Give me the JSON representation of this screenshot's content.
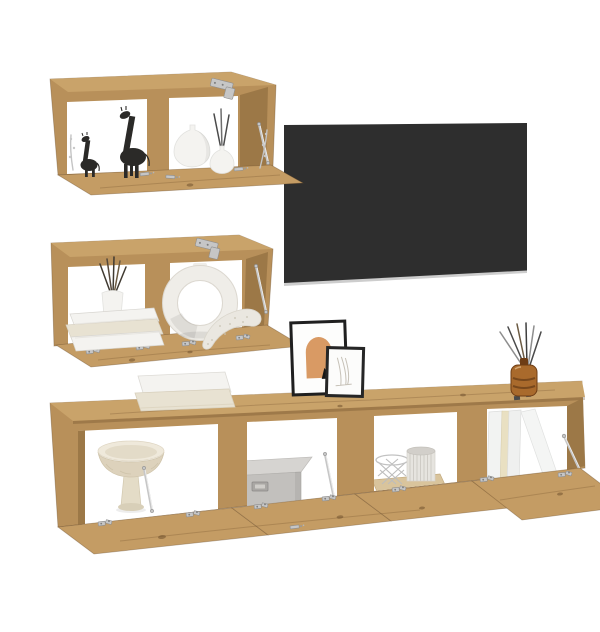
{
  "meta": {
    "title": "TV wall unit set in artisan oak - product image",
    "description": "Five-piece wall-mounted TV cabinet set in artisan oak with open fold-down doors, styled with giraffe figurines, white vases, books, a ring sculpture, a grey storage box, baskets, binders, two art frames, a reed diffuser and a wall-mounted flat screen TV on a white background."
  },
  "colors": {
    "background": "#ffffff",
    "wood-mid": "#b8905a",
    "wood-top": "#c9a36a",
    "wood-flap": "#c49c64",
    "wood-dark": "#9c7847",
    "wood-board": "#d9c49c",
    "tv-screen": "#2e2e2e",
    "tv-edge": "#cdcdcd",
    "metal": "#c6c6c6",
    "metal-dark": "#8e8e8e",
    "decor-white": "#f4f3f0",
    "decor-cream": "#e8e2d2",
    "gray-box-front": "#c2c0bd",
    "gray-box-top": "#d6d4d1",
    "figure-black": "#2b2a28",
    "art-orange": "#d99a64",
    "frame-black": "#1f1f1f",
    "amber": "#a96a2c",
    "amber-dark": "#6e3d15"
  },
  "scene": {
    "tv": {
      "label": "Wall-mounted flat screen TV"
    },
    "wall_cabinet_top": {
      "label": "Wall-mounted cabinet, artisan oak, two open compartments with fold-down door",
      "decor": {
        "twig_left": "Silver twig ornament",
        "giraffe_small": "Black giraffe figurine (small)",
        "giraffe_large": "Black giraffe figurine (large)",
        "vase_large": "Large white teardrop vase",
        "vase_small": "Small white vase with reed sticks",
        "twig_right": "Silver twig ornament"
      }
    },
    "wall_cabinet_middle": {
      "label": "Wall-mounted cabinet, artisan oak, two open compartments with fold-down door",
      "decor": {
        "reed_vase": "White vase with dark reed sticks",
        "books": "Stack of white books",
        "ring": "White ring-shaped sculpture",
        "horn": "Speckled horn ornament"
      }
    },
    "tv_stand": {
      "label": "Low TV stand, artisan oak, four open compartments with fold-down doors",
      "decor": {
        "books_top": "Stack of white and cream books",
        "pedestal_bowl": "Fluted pedestal bowl",
        "storage_box": "Grey fabric storage box with metal label plate",
        "wire_basket": "Silver wire basket",
        "ribbed_pot": "Ribbed white pot",
        "wood_board": "Light wood board",
        "binders": "White books and binders",
        "diffuser": "Amber reed diffuser bottle"
      }
    },
    "art_frames": {
      "label": "Two leaning picture frames",
      "large": "Framed orange abstract print",
      "small": "Framed grey sketch"
    },
    "hardware": {
      "hinge": "Metal hinge",
      "stay": "Lid stay rod",
      "bracket": "Wall-mount bracket",
      "loose": "Loose metal fittings",
      "mount": "Mounting hardware"
    }
  }
}
